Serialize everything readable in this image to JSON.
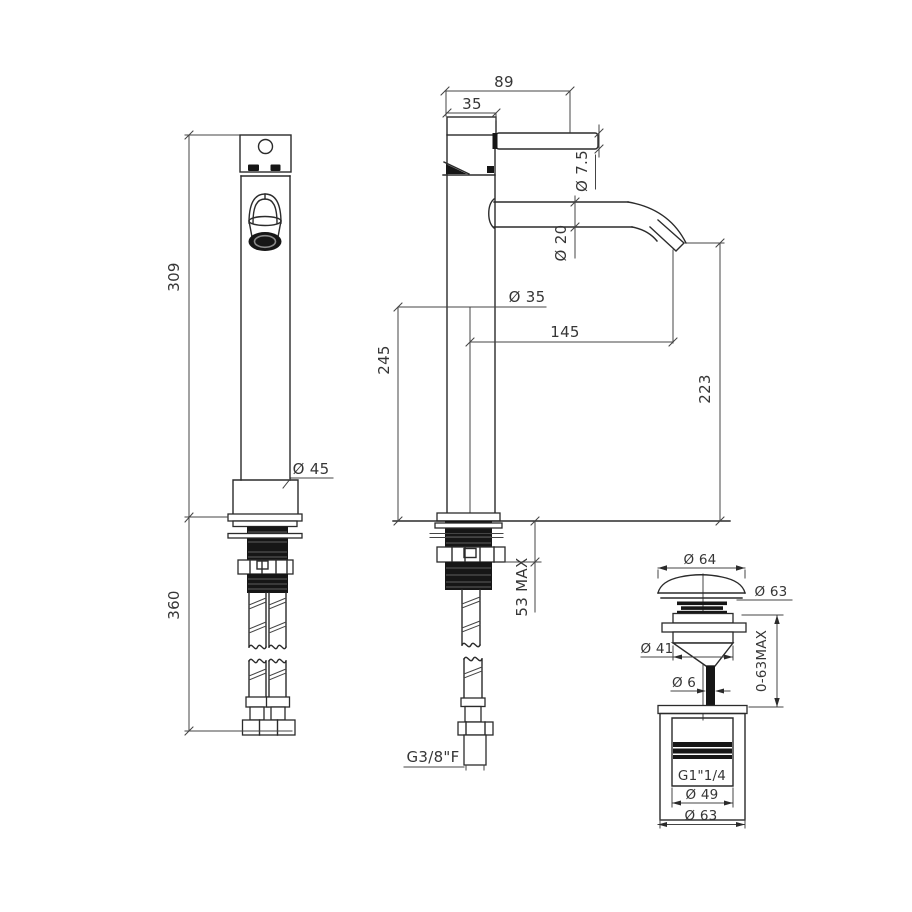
{
  "drawing": {
    "front": {
      "overall_height": "309",
      "under_counter_length": "360",
      "base_diameter": "Ø 45"
    },
    "side": {
      "overall_depth": "89",
      "handle_depth": "35",
      "lever_diameter": "Ø 7.5",
      "spout_diameter": "Ø 20",
      "body_diameter": "Ø 35",
      "spout_reach": "145",
      "height_to_spout": "245",
      "outlet_height": "223",
      "max_deck": "53 MAX",
      "inlet_thread": "G3/8\"F"
    },
    "waste": {
      "cap_diameter": "Ø 64",
      "plug_diameter": "Ø 63",
      "flange_diameter": "Ø 41",
      "stem_diameter": "Ø 6",
      "travel_range": "0-63MAX",
      "thread": "G1\"1/4",
      "bore_diameter": "Ø 49",
      "body_diameter": "Ø 63"
    }
  }
}
